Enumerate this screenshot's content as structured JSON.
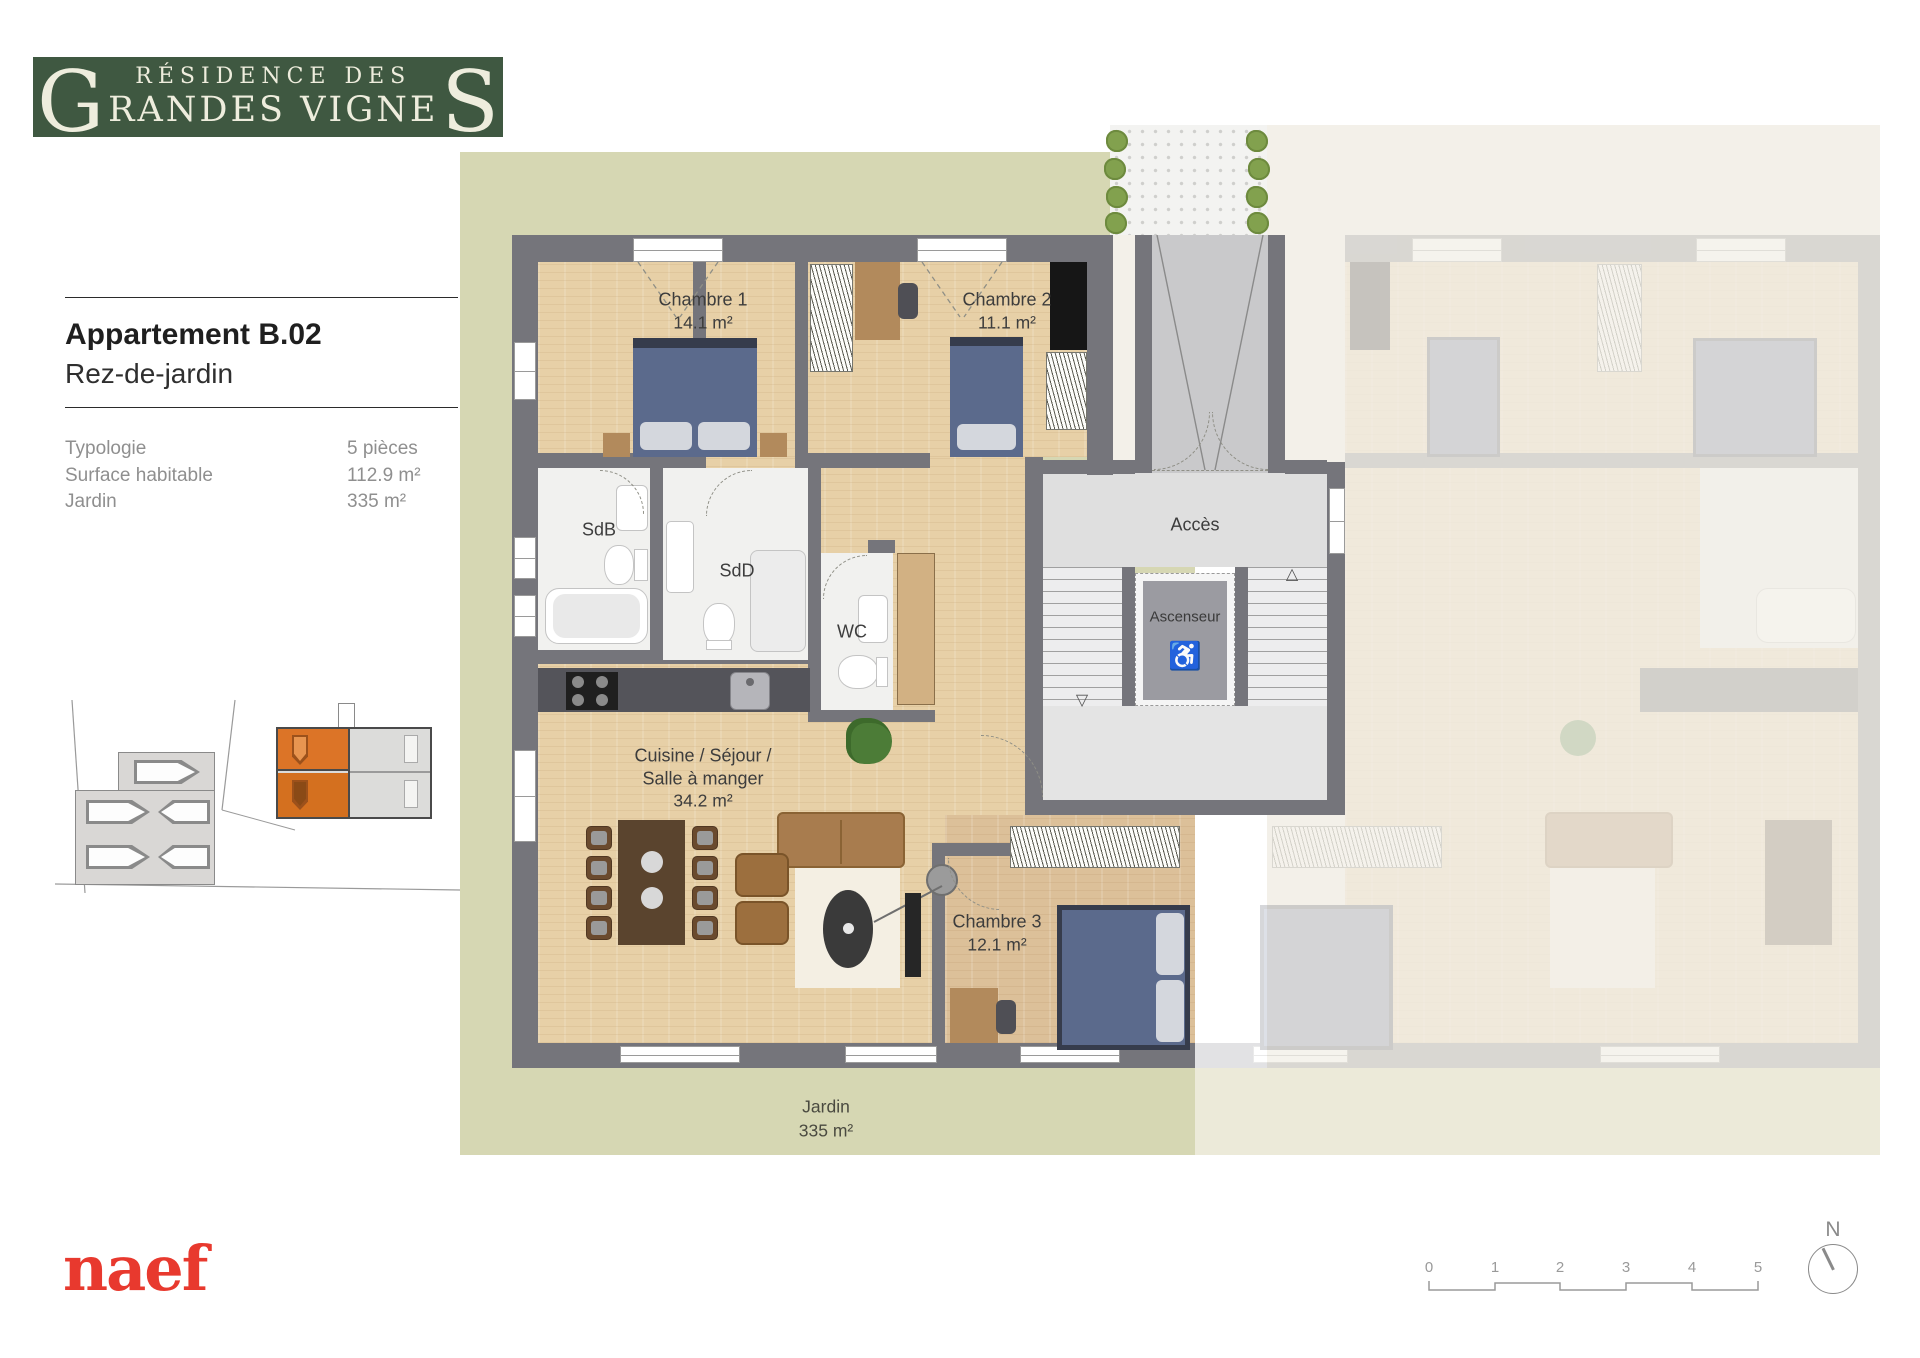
{
  "logo": {
    "prefix_letter": "G",
    "line1": "RÉSIDENCE DES",
    "line2_rest": "RANDES VIGNE",
    "suffix_letter": "S",
    "bg_color": "#3f5841",
    "text_color": "#eeeddd"
  },
  "panel": {
    "title": "Appartement B.02",
    "subtitle": "Rez-de-jardin",
    "specs": [
      {
        "label": "Typologie",
        "value": "5 pièces"
      },
      {
        "label": "Surface habitable",
        "value": "112.9 m²"
      },
      {
        "label": "Jardin",
        "value": "335 m²"
      }
    ]
  },
  "plan": {
    "rooms": {
      "chambre1": {
        "name": "Chambre 1",
        "area": "14.1 m²"
      },
      "chambre2": {
        "name": "Chambre 2",
        "area": "11.1 m²"
      },
      "chambre3": {
        "name": "Chambre 3",
        "area": "12.1 m²"
      },
      "sdb": "SdB",
      "sdd": "SdD",
      "wc": "WC",
      "acces": "Accès",
      "ascenseur": "Ascenseur",
      "cuisine": {
        "line1": "Cuisine / Séjour /",
        "line2": "Salle à manger",
        "area": "34.2 m²"
      },
      "jardin": {
        "name": "Jardin",
        "area": "335 m²"
      }
    },
    "colors": {
      "garden_green": "#d6d7b3",
      "wall_gray": "#75757b",
      "wood": "#e7d0a7",
      "bed_blue": "#5b6a8c",
      "highlight_orange": "#dc7427",
      "faded_beige": "#f3f0e9"
    }
  },
  "icons": {
    "wheelchair": "♿",
    "stair_up": "△",
    "stair_down": "▽"
  },
  "footer": {
    "brand": "naef",
    "brand_color": "#e8392e",
    "scale_ticks": [
      "0",
      "1",
      "2",
      "3",
      "4",
      "5"
    ],
    "north_label": "N"
  }
}
